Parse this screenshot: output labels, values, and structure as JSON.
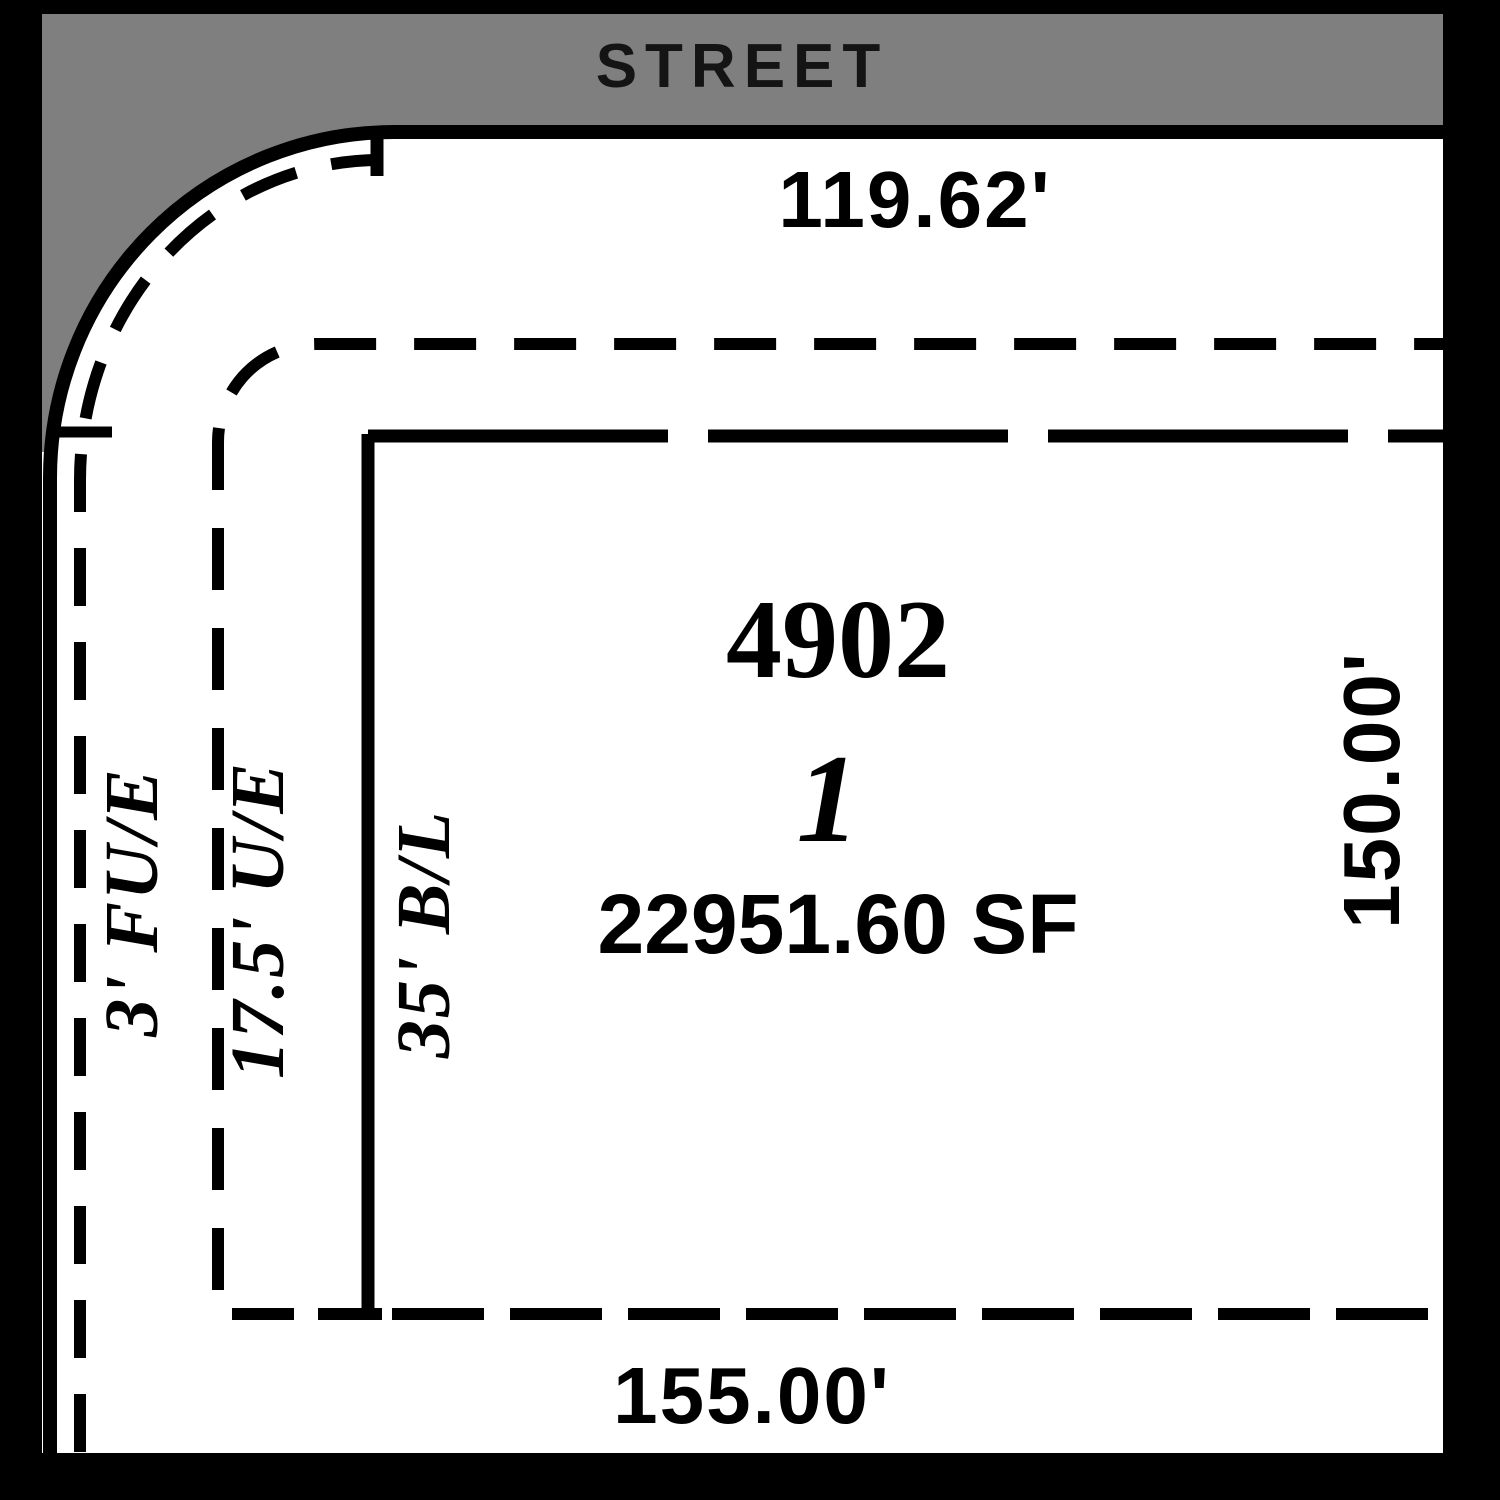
{
  "street": {
    "label": "STREET"
  },
  "lot": {
    "house_number": "4902",
    "lot_number": "1",
    "area": "22951.60 SF"
  },
  "dimensions": {
    "front": "119.62'",
    "side_right": "150.00'",
    "rear": "155.00'"
  },
  "easements": {
    "franchise_utility": "3' FU/E",
    "utility": "17.5' U/E",
    "building_line": "35' B/L"
  },
  "colors": {
    "street_gray": "#7f7f7f",
    "line_black": "#000000",
    "paper_white": "#ffffff"
  }
}
